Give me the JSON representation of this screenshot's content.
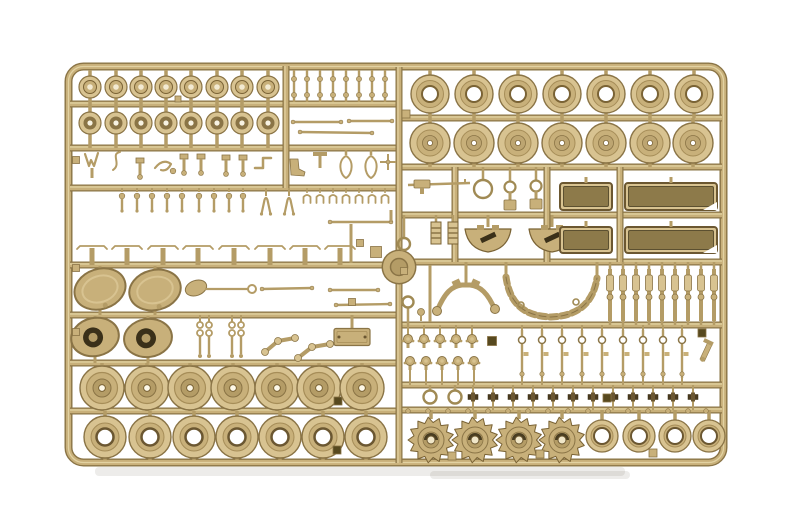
{
  "palette": {
    "bg": "#ffffff",
    "light": "#d8c391",
    "mid": "#c8b07a",
    "mid2": "#b49c66",
    "dark": "#8a7446",
    "outline": "#7a6335",
    "deep": "#6b5731",
    "hole": "#3a3019",
    "tub": "#8d7a4a",
    "highlight": "#e2d2a2",
    "white": "#ffffff",
    "shadow": "rgba(110,100,80,0.12)"
  },
  "frame": {
    "x": 68.5,
    "y": 66.5,
    "w": 655,
    "h": 396,
    "corner_radius": 15
  },
  "runners": {
    "split_x": 399,
    "left_horizontal_y": [
      104,
      148,
      188,
      265,
      315,
      363,
      411
    ],
    "right_horizontal_y": [
      118,
      167,
      215,
      262,
      325,
      385,
      410
    ],
    "verticals": [
      {
        "x": 286,
        "y1": 66,
        "y2": 188
      },
      {
        "x": 455,
        "y1": 167,
        "y2": 262
      },
      {
        "x": 547,
        "y1": 167,
        "y2": 262
      },
      {
        "x": 620,
        "y1": 167,
        "y2": 262
      }
    ],
    "boss": {
      "x": 399,
      "y": 267,
      "outer_r": 16,
      "inner_r": 8.5
    }
  },
  "shadows": [
    {
      "x": 95,
      "y": 467,
      "w": 530,
      "h": 9
    },
    {
      "x": 430,
      "y": 471,
      "w": 200,
      "h": 8
    }
  ],
  "wheel_rows": [
    {
      "name": "cap-wheel",
      "type": "cap",
      "y": 87,
      "xs": [
        90,
        116,
        141,
        166,
        191,
        217,
        242,
        268
      ],
      "stub_up": 70,
      "stub_down": 104
    },
    {
      "name": "hub-wheel",
      "type": "hub",
      "y": 123,
      "xs": [
        90,
        116,
        141,
        166,
        191,
        217,
        242,
        268
      ],
      "stub_up": 104,
      "stub_down": 148
    },
    {
      "name": "large-ring-wheel",
      "type": "bigring",
      "y": 94,
      "xs": [
        430,
        474,
        518,
        562,
        606,
        650,
        694
      ],
      "stub_up": 70,
      "stub_down": 118
    },
    {
      "name": "large-hub-wheel",
      "type": "bighub",
      "y": 143,
      "xs": [
        430,
        474,
        518,
        562,
        606,
        650,
        693
      ],
      "stub_up": 118,
      "stub_down": 167
    },
    {
      "name": "road-wheel",
      "type": "road",
      "y": 388,
      "xs": [
        102,
        147,
        190,
        233,
        277,
        319,
        362
      ],
      "stub_up": 363,
      "stub_down": 411
    },
    {
      "name": "ring-wheel",
      "type": "ringL",
      "y": 437,
      "xs": [
        105,
        150,
        194,
        237,
        280,
        323,
        366
      ],
      "stub_up": 411,
      "stub_down": 460
    },
    {
      "name": "sprocket-wheel",
      "type": "sprocket",
      "y": 440,
      "xs": [
        431,
        475,
        519,
        562
      ],
      "stub_up": 410
    },
    {
      "name": "idler-ring-wheel",
      "type": "smallRing",
      "y": 436,
      "xs": [
        602,
        639,
        675,
        709
      ],
      "stub_up": 410
    }
  ],
  "detail_parts": [
    {
      "name": "pin-comb",
      "type": "comb_posts",
      "xs": [
        294,
        307,
        320,
        333,
        346,
        359,
        372,
        385
      ],
      "y1": 70,
      "y2": 102,
      "bead_ys": [
        79,
        95
      ]
    },
    {
      "name": "thin-rod",
      "type": "rod",
      "x1": 293,
      "y1": 122,
      "x2": 341,
      "y2": 122
    },
    {
      "name": "thin-rod",
      "type": "rod",
      "x1": 300,
      "y1": 132,
      "x2": 372,
      "y2": 133
    },
    {
      "name": "thin-rod",
      "type": "rod",
      "x1": 349,
      "y1": 121,
      "x2": 392,
      "y2": 121
    },
    {
      "name": "v-bracket",
      "type": "vbracket",
      "x": 92,
      "y": 162
    },
    {
      "name": "s-hook",
      "type": "shook",
      "x": 116,
      "y": 162
    },
    {
      "name": "square-head-post",
      "type": "posthead",
      "x": 140,
      "y": 164
    },
    {
      "name": "claw-hook",
      "type": "clawhook",
      "x": 163,
      "y": 166
    },
    {
      "name": "square-head-post",
      "type": "posthead",
      "x": 184,
      "y": 160
    },
    {
      "name": "square-head-post",
      "type": "posthead",
      "x": 201,
      "y": 160
    },
    {
      "name": "square-head-post",
      "type": "posthead",
      "x": 226,
      "y": 161
    },
    {
      "name": "square-head-post",
      "type": "posthead",
      "x": 243,
      "y": 161
    },
    {
      "name": "angle-bracket",
      "type": "anglebracket",
      "x": 263,
      "y": 164
    },
    {
      "name": "boot-bracket",
      "type": "boot",
      "x": 296,
      "y": 167
    },
    {
      "name": "t-bracket",
      "type": "tbracket",
      "x": 320,
      "y": 160
    },
    {
      "name": "tow-loop",
      "type": "loop_outline",
      "x": 346,
      "y": 166
    },
    {
      "name": "tow-loop",
      "type": "loop_outline",
      "x": 371,
      "y": 166
    },
    {
      "name": "cross-part",
      "type": "cross_part",
      "x": 388,
      "y": 162
    },
    {
      "name": "hanging-pins",
      "type": "pin_row",
      "xs": [
        122,
        137,
        152,
        167,
        182,
        199,
        214,
        229,
        243
      ],
      "y": 190
    },
    {
      "name": "wishbone-fork",
      "type": "fork",
      "x": 266,
      "y": 196
    },
    {
      "name": "wishbone-fork",
      "type": "fork",
      "x": 289,
      "y": 196
    },
    {
      "name": "spring-clips",
      "type": "clip_row",
      "xs": [
        307,
        320,
        333,
        346,
        359,
        372,
        385
      ],
      "y": 193
    },
    {
      "name": "bracket-strips",
      "type": "strip_row",
      "xs": [
        92,
        127,
        163,
        198,
        234,
        270,
        305,
        340
      ],
      "y": 246,
      "half": 15,
      "runner_y": 265
    },
    {
      "name": "vertical-rod",
      "type": "vrod",
      "x": 351,
      "y1": 224,
      "y2": 263
    },
    {
      "name": "gate-tab",
      "type": "tab",
      "x": 360,
      "y": 243,
      "s": 7
    },
    {
      "name": "gate-tab",
      "type": "tab",
      "x": 376,
      "y": 252,
      "s": 11
    },
    {
      "name": "thin-rod",
      "type": "rod",
      "x1": 330,
      "y1": 222,
      "x2": 391,
      "y2": 222
    },
    {
      "name": "vertical-rod",
      "type": "vrod",
      "x": 391,
      "y1": 210,
      "y2": 222
    },
    {
      "name": "final-drive-pod",
      "type": "pod_solid",
      "x": 100,
      "y": 289,
      "rot": -18
    },
    {
      "name": "final-drive-pod",
      "type": "pod_solid",
      "x": 155,
      "y": 290,
      "rot": -14
    },
    {
      "name": "shovel",
      "type": "shovel",
      "x": 196,
      "y": 288
    },
    {
      "name": "linkage-rod",
      "type": "rod",
      "x1": 262,
      "y1": 289,
      "x2": 312,
      "y2": 288
    },
    {
      "name": "linkage-rod",
      "type": "rod",
      "x1": 330,
      "y1": 290,
      "x2": 378,
      "y2": 290
    },
    {
      "name": "linkage-rod",
      "type": "rod",
      "x1": 336,
      "y1": 305,
      "x2": 390,
      "y2": 304
    },
    {
      "name": "gate-tab",
      "type": "tab",
      "x": 352,
      "y": 302,
      "s": 7
    },
    {
      "name": "hub-pod",
      "type": "pod_hole",
      "x": 95,
      "y": 337,
      "rot": -12
    },
    {
      "name": "hub-pod",
      "type": "pod_hole",
      "x": 148,
      "y": 338,
      "rot": -8
    },
    {
      "name": "link-pair",
      "type": "link_pair",
      "xs": [
        200,
        209
      ],
      "top": 318
    },
    {
      "name": "link-pair",
      "type": "link_pair",
      "xs": [
        232,
        241
      ],
      "top": 318
    },
    {
      "name": "crank-arm",
      "type": "crank",
      "pts": [
        [
          265,
          352
        ],
        [
          278,
          341
        ],
        [
          295,
          338
        ]
      ]
    },
    {
      "name": "crank-arm",
      "type": "crank",
      "pts": [
        [
          298,
          358
        ],
        [
          312,
          347
        ],
        [
          330,
          344
        ]
      ]
    },
    {
      "name": "cover-plate",
      "type": "plate",
      "x": 352,
      "y": 337,
      "w": 36,
      "h": 17
    },
    {
      "name": "gate-tab",
      "type": "tab",
      "x": 178,
      "y": 99,
      "s": 6
    },
    {
      "name": "gate-tab",
      "type": "tab",
      "x": 338,
      "y": 401,
      "s": 8,
      "dark": true
    },
    {
      "name": "gate-tab",
      "type": "tab",
      "x": 337,
      "y": 450,
      "s": 8,
      "dark": true
    },
    {
      "name": "rail-tab",
      "type": "tab",
      "x": 76,
      "y": 160,
      "s": 7
    },
    {
      "name": "rail-tab",
      "type": "tab",
      "x": 76,
      "y": 268,
      "s": 7
    },
    {
      "name": "rail-tab",
      "type": "tab",
      "x": 76,
      "y": 332,
      "s": 7
    },
    {
      "name": "machine-gun",
      "type": "mgun",
      "x": 408,
      "y": 185
    },
    {
      "name": "ring-sight",
      "type": "ring_open",
      "x": 483,
      "y": 189,
      "r": 9,
      "stub_up": 167
    },
    {
      "name": "eyelet-post",
      "type": "hole_post",
      "x": 510,
      "y": 187
    },
    {
      "name": "eyelet-post",
      "type": "hole_post",
      "x": 536,
      "y": 186
    },
    {
      "name": "gate-tab",
      "type": "tab",
      "x": 406,
      "y": 114,
      "s": 8
    },
    {
      "name": "eyelet",
      "type": "ring_open",
      "x": 404,
      "y": 244,
      "r": 6,
      "stub_up": 215
    },
    {
      "name": "grille-ladder",
      "type": "ladder",
      "x": 436,
      "y": 233,
      "stub_up": 215
    },
    {
      "name": "grille-ladder",
      "type": "ladder",
      "x": 453,
      "y": 233,
      "stub_up": 215
    },
    {
      "name": "half-moon-mount",
      "type": "halfmoon",
      "x": 488,
      "y": 236
    },
    {
      "name": "half-moon-mount",
      "type": "halfmoon",
      "x": 552,
      "y": 236
    },
    {
      "name": "stowage-tub",
      "type": "tub",
      "x": 560,
      "y": 183,
      "w": 52,
      "h": 27
    },
    {
      "name": "stowage-tub-long",
      "type": "tub",
      "x": 625,
      "y": 183,
      "w": 92,
      "h": 27,
      "chamfer": true
    },
    {
      "name": "stowage-tub",
      "type": "tub",
      "x": 560,
      "y": 227,
      "w": 52,
      "h": 26
    },
    {
      "name": "stowage-tub-long",
      "type": "tub",
      "x": 625,
      "y": 227,
      "w": 92,
      "h": 26,
      "chamfer": true
    },
    {
      "name": "idler-wishbone",
      "type": "vpart",
      "cx": 466,
      "top": 262
    },
    {
      "name": "track-run",
      "type": "chain",
      "x1": 506,
      "x2": 597,
      "y_top": 277,
      "runner_y": 262
    },
    {
      "name": "shock-absorbers",
      "type": "damper_row",
      "xs": [
        610,
        623,
        636,
        649,
        662,
        675,
        688,
        701,
        714
      ],
      "y1": 269,
      "y2": 321,
      "up": 262,
      "down": 325
    },
    {
      "name": "eyelet",
      "type": "ring_open",
      "x": 408,
      "y": 302,
      "r": 5.5,
      "stub_down": 325
    },
    {
      "name": "vertical-rod",
      "type": "vrod",
      "x": 430,
      "y1": 265,
      "y2": 322
    },
    {
      "name": "small-knob",
      "type": "knob",
      "x": 421,
      "y": 312
    },
    {
      "name": "gate-tab",
      "type": "tab",
      "x": 404,
      "y": 271,
      "s": 7
    },
    {
      "name": "bolt-heads",
      "type": "mushroom_row",
      "xs": [
        408,
        424,
        440,
        456,
        472
      ],
      "y": 339,
      "up": 325
    },
    {
      "name": "bolt-heads",
      "type": "mushroom_row",
      "xs": [
        410,
        426,
        442,
        458,
        474
      ],
      "y": 361,
      "down": 385
    },
    {
      "name": "gate-tab",
      "type": "tab",
      "x": 492,
      "y": 341,
      "s": 9,
      "dark": true
    },
    {
      "name": "suspension-links",
      "type": "link_row",
      "xs": [
        522,
        542,
        562,
        582,
        602,
        623,
        643,
        663,
        682
      ],
      "y1": 330,
      "y2": 378,
      "up": 325,
      "down": 385
    },
    {
      "name": "small-pistol-part",
      "type": "pistol",
      "x": 706,
      "y": 352
    },
    {
      "name": "gate-tab",
      "type": "tab",
      "x": 702,
      "y": 333,
      "s": 8,
      "dark": true
    },
    {
      "name": "tow-ring",
      "type": "ring_open",
      "x": 430,
      "y": 397,
      "r": 6.5,
      "stub_up": 385
    },
    {
      "name": "tow-ring",
      "type": "ring_open",
      "x": 455,
      "y": 397,
      "r": 6.5,
      "stub_up": 385
    },
    {
      "name": "track-cleats",
      "type": "cleat_row",
      "xs": [
        473,
        493,
        513,
        533,
        553,
        573,
        593,
        613,
        633,
        653,
        673,
        693
      ],
      "y": 397,
      "up": 385,
      "down": 410
    },
    {
      "name": "gate-pellets",
      "type": "pellet_row",
      "xs": [
        408,
        428,
        448,
        468,
        488,
        508,
        528,
        548,
        568,
        588,
        608,
        628,
        648,
        668,
        688,
        706
      ],
      "y": 411
    },
    {
      "name": "gate-tab",
      "type": "tab",
      "x": 452,
      "y": 456,
      "s": 8
    },
    {
      "name": "gate-tab",
      "type": "tab",
      "x": 540,
      "y": 454,
      "s": 8
    },
    {
      "name": "gate-tab",
      "type": "tab",
      "x": 653,
      "y": 453,
      "s": 8
    },
    {
      "name": "gate-tab",
      "type": "tab",
      "x": 607,
      "y": 398,
      "s": 8,
      "dark": true
    }
  ]
}
